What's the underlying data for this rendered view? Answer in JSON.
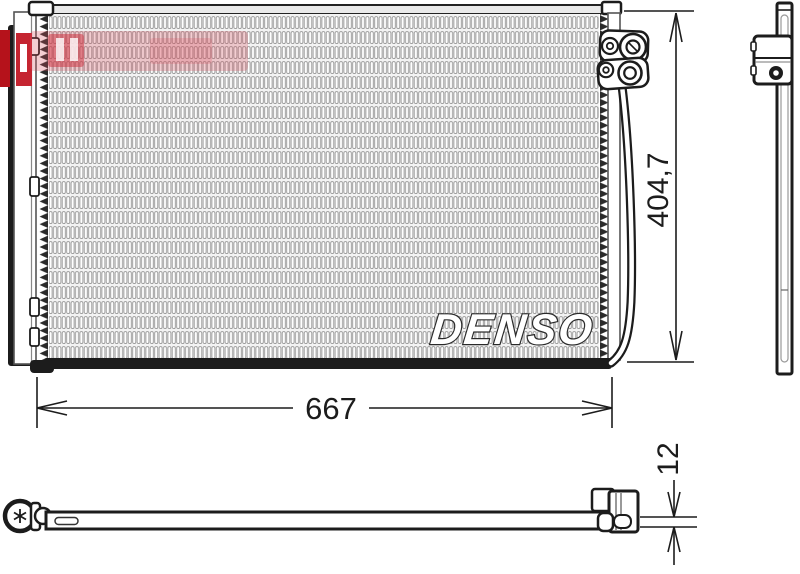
{
  "page": {
    "type": "technical-part-drawing",
    "background": "#ffffff",
    "line_color": "#1c1c1c"
  },
  "brand": {
    "logo_text": "DENSO"
  },
  "dimensions": {
    "width_mm": "667",
    "height_mm": "404,7",
    "thickness_mm": "12"
  },
  "watermark": {
    "color_solid": "#b5121b",
    "color_translucent": "#d94f5c"
  },
  "icons": {
    "screw": "torx-screw-icon",
    "bolt": "bolt-head-icon"
  }
}
